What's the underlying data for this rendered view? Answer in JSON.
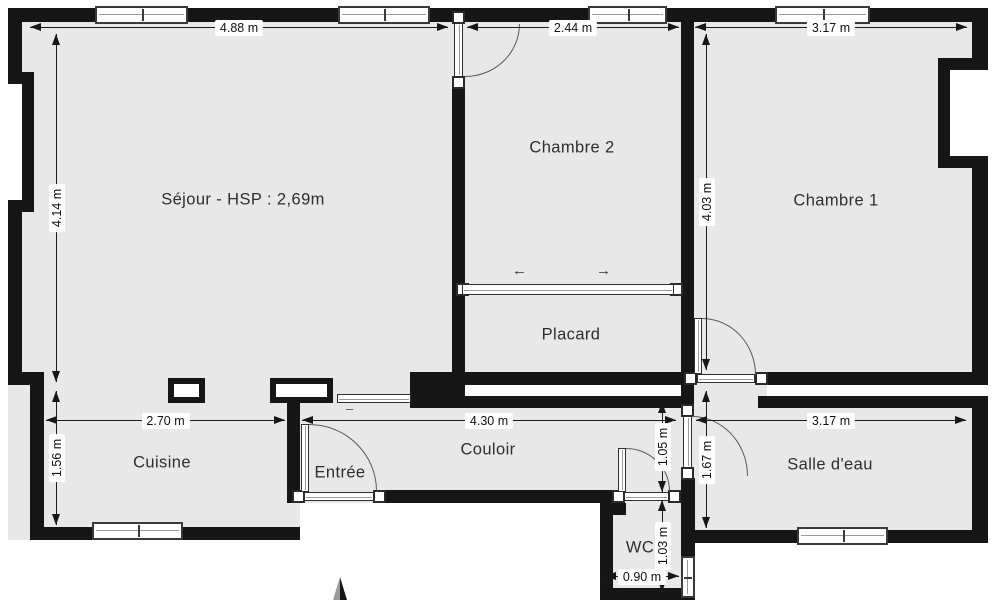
{
  "plan": {
    "rooms": {
      "sejour": "Séjour - HSP : 2,69m",
      "chambre2": "Chambre 2",
      "chambre1": "Chambre 1",
      "placard": "Placard",
      "cuisine": "Cuisine",
      "entree": "Entrée",
      "couloir": "Couloir",
      "salle_deau": "Salle d'eau",
      "wc": "WC"
    },
    "dims": {
      "sejour_width": "4.88 m",
      "chambre2_width": "2.44 m",
      "chambre1_width": "3.17 m",
      "sejour_height": "4.14 m",
      "chambre1_height": "4.03 m",
      "cuisine_width": "2.70 m",
      "cuisine_height": "1.56 m",
      "couloir_length": "4.30 m",
      "couloir_width": "1.05 m",
      "salle_deau_height": "1.67 m",
      "salle_deau_width": "3.17 m",
      "wc_height": "1.03 m",
      "wc_width": "0.90 m"
    },
    "icons": {
      "slide_left": "←",
      "slide_right": "→",
      "separator_dash": "–"
    },
    "colors": {
      "wall": "#161616",
      "floor": "#e8e8e8",
      "outside": "#ffffff"
    }
  }
}
